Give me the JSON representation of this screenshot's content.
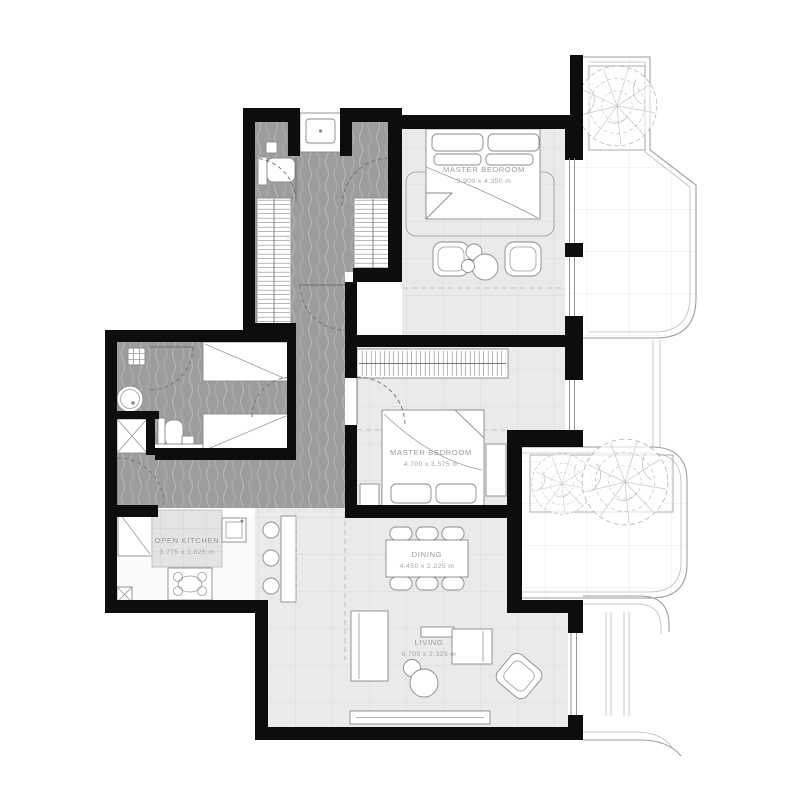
{
  "rooms": {
    "master_bedroom_1": {
      "name": "MASTER BEDROOM",
      "dims": "3.900 x 4.350 m"
    },
    "master_bedroom_2": {
      "name": "MASTER BEDROOM",
      "dims": "4.700 x 3.575 m"
    },
    "dining": {
      "name": "DINING",
      "dims": "4.450 x 2.225 m"
    },
    "living": {
      "name": "LIVING",
      "dims": "6.700 x 2.325 m"
    },
    "kitchen": {
      "name": "OPEN KITCHEN",
      "dims": "3.775 x 1.825 m"
    },
    "walk_in": {
      "name": "WALK-IN CLOSET"
    }
  },
  "colors": {
    "wall": "#0d0d0d",
    "wet_floor": "#9d9d9d",
    "wet_wave": "#b9b9b9",
    "tile_floor": "#eaeaea",
    "tile_line": "#d6d6d6",
    "balcony_line": "#9e9e9e",
    "label_text": "#9a9a9a",
    "fixture_stroke": "#8a8a8a"
  }
}
